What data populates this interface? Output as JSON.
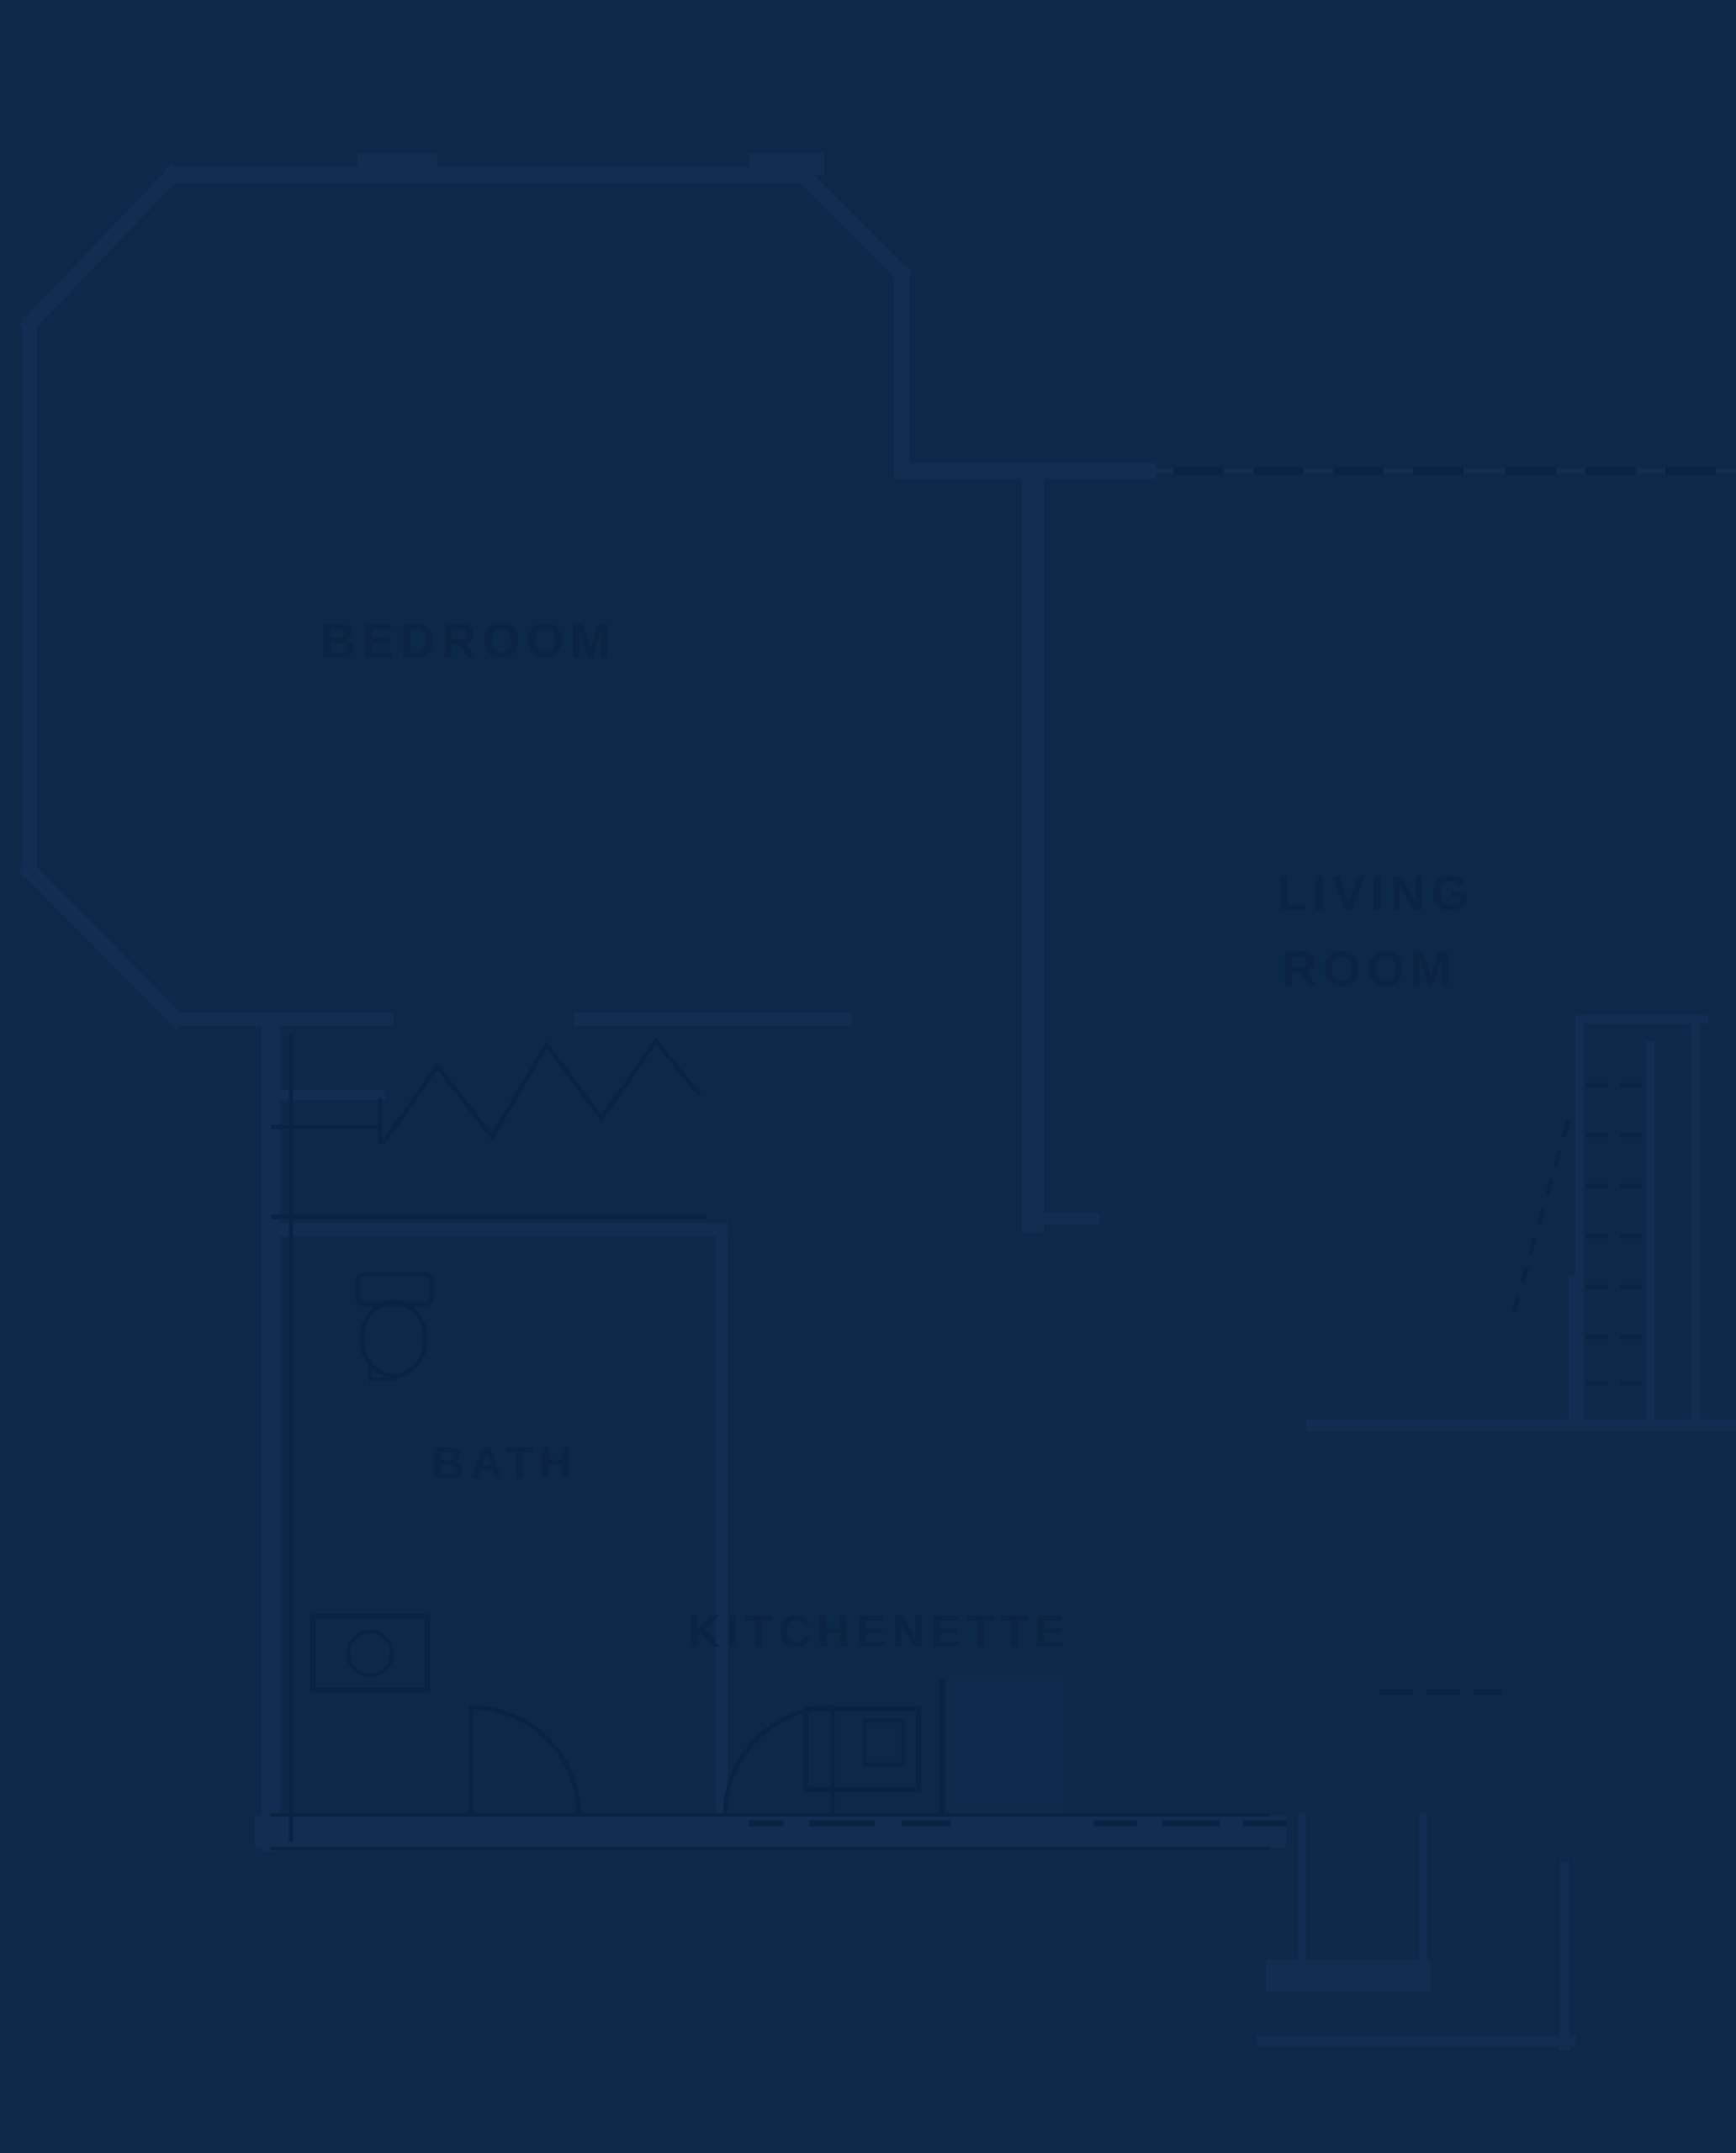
{
  "document": {
    "kind": "apartment floor plan drawing, extremely low contrast dark navy blueprint",
    "background_color": "#0d2949",
    "wall_color": "#112e52",
    "detail_line_color": "#0a2342",
    "label_color": "#0b2444"
  },
  "rooms": {
    "bedroom": {
      "label": "BEDROOM"
    },
    "living_room": {
      "label_line1": "LIVING",
      "label_line2": "ROOM"
    },
    "bath": {
      "label": "BATH"
    },
    "kitchenette": {
      "label": "KITCHENETTE"
    }
  },
  "fixtures": {
    "toilet": "toilet-symbol",
    "sink": "sink-symbol",
    "range": "oven-range-symbol",
    "closet_doors": "bifold-door-zigzag",
    "bath_door": "door-swing-arc",
    "kitchen_door": "door-swing-arc",
    "stairs": "dashed-stair-treads",
    "rear_steps": "exterior-steps",
    "windows": "window-tick-marks"
  }
}
